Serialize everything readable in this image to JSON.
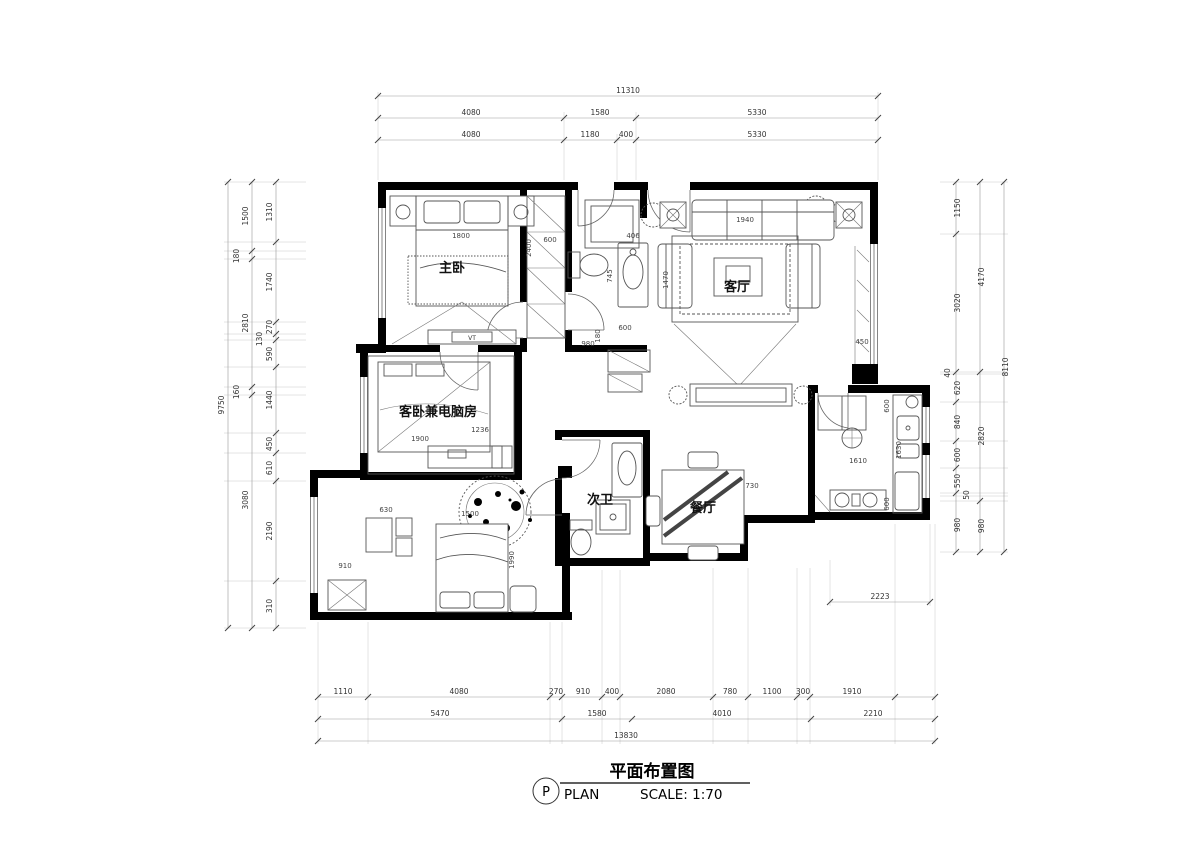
{
  "title_block": {
    "circle_letter": "P",
    "title_cn": "平面布置图",
    "plan_label": "PLAN",
    "scale_label": "SCALE: 1:70"
  },
  "rooms": {
    "master_bedroom": "主卧",
    "guest_bedroom": "客卧兼电脑房",
    "living_room": "客厅",
    "second_bath": "次卫",
    "dining_room": "餐厅",
    "tv_label": "VT"
  },
  "dims": {
    "top": {
      "total": "11310",
      "row2": [
        "4080",
        "1580",
        "5330"
      ],
      "row3": [
        "4080",
        "1180",
        "400",
        "5330"
      ]
    },
    "bottom": {
      "row1": [
        "1110",
        "4080",
        "270",
        "910",
        "400",
        "2080",
        "780",
        "1100",
        "300",
        "1910"
      ],
      "row2": [
        "5470",
        "1580",
        "4010",
        "2210"
      ],
      "total": "13830"
    },
    "left": {
      "inner": [
        "1310",
        "1740",
        "270",
        "130",
        "590",
        "1440",
        "450",
        "610",
        "2190",
        "310"
      ],
      "mid": [
        "1500",
        "180",
        "2810",
        "160",
        "3080"
      ],
      "total": "9750"
    },
    "right": {
      "inner": [
        "1150",
        "3020",
        "40",
        "620",
        "840",
        "600",
        "550",
        "50",
        "980"
      ],
      "mid": [
        "4170",
        "2820",
        "980"
      ],
      "total": "8110"
    },
    "corner_br": "2223",
    "interior": {
      "bed_w": "1800",
      "bed_d": "2400",
      "hall_w": "600",
      "basin_w": "406",
      "basin_d": "745",
      "hall_l": "980",
      "niche": "180",
      "wash": "600",
      "sofa_w": "1940",
      "rug_d": "1470",
      "bay_d": "450",
      "dining": "730",
      "kitchen_w": "1610",
      "kitchen_d": "1630",
      "k_top": "600",
      "k_bot": "600",
      "bed2_w": "1500",
      "bed2_d": "1990",
      "closet2": "910",
      "desk2": "630",
      "desk1": "1236",
      "bed3": "1900"
    }
  }
}
